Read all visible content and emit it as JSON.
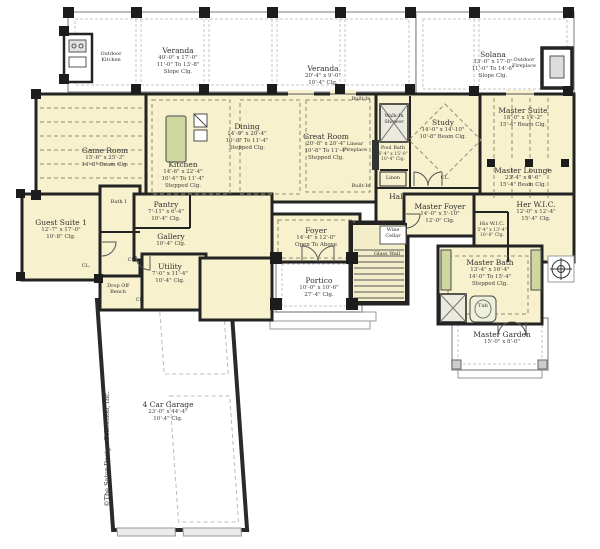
{
  "colors": {
    "paper": "#ffffff",
    "interior_fill": "#f7f1cd",
    "wall": "#232323",
    "outdoor_line": "#a6a6a6",
    "cabinet_green": "#cfd6a0",
    "ceiling_dash": "#8f8f75"
  },
  "copyright": "©The Sater Design Collection, Inc.",
  "rooms": {
    "veranda1": {
      "name": "Veranda",
      "l1": "40'-0\" x 17'-0\"",
      "l2": "11'-0\" To 13'-8\"",
      "l3": "Slope Clg."
    },
    "veranda2": {
      "name": "Veranda",
      "l1": "20'-4\" x 9'-0\"",
      "l2": "10'-4\" Clg."
    },
    "solana": {
      "name": "Solana",
      "l1": "33'-0\" x 17'-0\"",
      "l2": "11'-0\" To 14'-6\"",
      "l3": "Slope Clg."
    },
    "game_room": {
      "name": "Game Room",
      "l1": "15'-6\" x 25'-3\"",
      "l2": "14'-8\" Beam Clg."
    },
    "kitchen": {
      "name": "Kitchen",
      "l1": "14'-6\" x 22'-4\"",
      "l2": "10'-4\" To 11'-4\"",
      "l3": "Stepped Clg."
    },
    "dining": {
      "name": "Dining",
      "l1": "14'-0\" x 20'-4\"",
      "l2": "10'-8\" To 11'-4\"",
      "l3": "Stepped Clg."
    },
    "great_room": {
      "name": "Great Room",
      "l1": "20'-8\" x 20'-4\"",
      "l2": "10'-8\" To 11'-4\"",
      "l3": "Stepped Clg."
    },
    "study": {
      "name": "Study",
      "l1": "14'-0\" x 14'-10\"",
      "l2": "10'-8\" Beam Clg."
    },
    "pool_bath": {
      "name": "Pool Bath",
      "l1": "6'-4\" x 15'-0\"",
      "l2": "10'-4\" Clg."
    },
    "master_suite": {
      "name": "Master Suite",
      "l1": "18'-0\" x 14'-2\"",
      "l2": "15'-4\" Beam Clg."
    },
    "master_lounge": {
      "name": "Master Lounge",
      "l1": "23'-4\" x 6'-6\"",
      "l2": "15'-4\" Beam Clg."
    },
    "hall": {
      "name": "Hall"
    },
    "master_foyer": {
      "name": "Master Foyer",
      "l1": "14'-0\" x 5'-10\"",
      "l2": "12'-0\" Clg."
    },
    "his_wic": {
      "name": "His W.I.C.",
      "l1": "5'-4\" x 13'-4\"",
      "l2": "10'-8\" Clg."
    },
    "her_wic": {
      "name": "Her W.I.C.",
      "l1": "12'-0\" x 12'-4\"",
      "l2": "15'-4\" Clg."
    },
    "master_bath": {
      "name": "Master Bath",
      "l1": "13'-4\" x 16'-4\"",
      "l2": "14'-0\" To 15'-4\"",
      "l3": "Stepped Clg."
    },
    "master_garden": {
      "name": "Master Garden",
      "l1": "15'-0\" x 8'-0\""
    },
    "guest_suite": {
      "name": "Guest Suite 1",
      "l1": "12'-7\" x 17'-0\"",
      "l2": "10'-8\" Clg."
    },
    "bath1": {
      "name": "Bath 1"
    },
    "pantry": {
      "name": "Pantry",
      "l1": "7'-11\" x 6'-4\"",
      "l2": "10'-4\" Clg."
    },
    "gallery": {
      "name": "Gallery",
      "l1": "10'-4\" Clg."
    },
    "utility": {
      "name": "Utility",
      "l1": "7'-0\" x 11'-4\"",
      "l2": "10'-4\" Clg."
    },
    "foyer": {
      "name": "Foyer",
      "l1": "14'-4\" x 12'-0\"",
      "l2": "Open To Above"
    },
    "portico": {
      "name": "Portico",
      "l1": "10'-0\" x 10'-6\"",
      "l2": "27'-4\" Clg."
    },
    "garage": {
      "name": "4 Car Garage",
      "l1": "23'-0\" x 44'-4\"",
      "l2": "10'-4\" Clg."
    }
  },
  "labels": {
    "outdoor_kitchen_1": "Outdoor",
    "outdoor_kitchen_2": "Kitchen",
    "outdoor_fireplace_1": "Outdoor",
    "outdoor_fireplace_2": "Fireplace",
    "wine_cellar_1": "Wine",
    "wine_cellar_2": "Cellar",
    "glass_wall": "Glass Wall",
    "linen": "Linen",
    "linear_fireplace_1": "Linear",
    "linear_fireplace_2": "Fireplace",
    "walk_in_shower_1": "Walk-In",
    "walk_in_shower_2": "Shower",
    "built_in": "Built-In",
    "closet": "CL.",
    "tub": "Tub",
    "drop_off_1": "Drop Off",
    "drop_off_2": "Bench"
  }
}
